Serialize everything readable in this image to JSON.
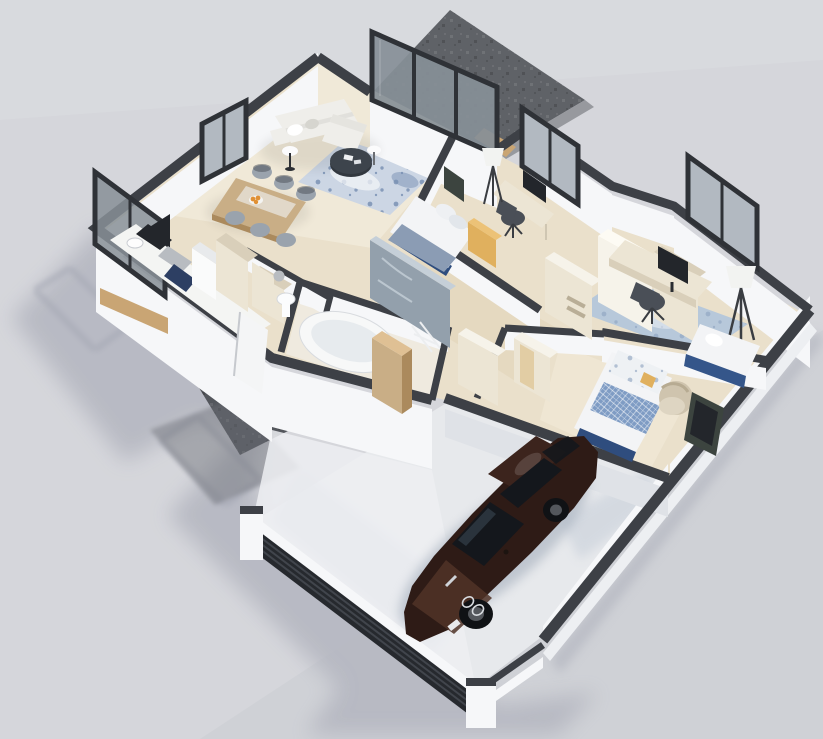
{
  "scene": {
    "title": "Isometric 3D floor plan render of a single-storey house with attached garage and parked sedan",
    "style": "photorealistic architectural visualization on plain light-gray backdrop, soft shadow cast to lower left",
    "rooms": [
      {
        "name": "terrace",
        "features": [
          "dark-stone-deck",
          "sliding-glass-door-wall"
        ]
      },
      {
        "name": "living-room",
        "features": [
          "white-l-shaped-sofa",
          "throw-pillows",
          "round-dark-coffee-table",
          "two-white-side-tables",
          "blue-speckled-rug",
          "wall-window"
        ]
      },
      {
        "name": "dining-area",
        "features": [
          "wood-dining-table",
          "six-gray-chairs",
          "orange-fruit-bowl"
        ]
      },
      {
        "name": "kitchen",
        "features": [
          "white-counter",
          "dark-cooktop",
          "steel-oven",
          "navy-cabinet-front",
          "white-fridge",
          "tall-cream-units",
          "glass-balustrade-window",
          "wood-planter-trim",
          "wall-art-panel"
        ]
      },
      {
        "name": "entry",
        "features": [
          "white-front-door-ajar",
          "dark-stone-walkway"
        ]
      },
      {
        "name": "wc",
        "features": [
          "pedestal-sink",
          "cream-shelf"
        ]
      },
      {
        "name": "bathroom",
        "features": [
          "oval-bathtub",
          "marble-shower-wall",
          "wood-cabinet",
          "towel-ladder"
        ]
      },
      {
        "name": "bedroom-1",
        "features": [
          "double-bed-gray-blue-blanket",
          "navy-bed-base",
          "yellow-wardrobe-panel",
          "desk-with-monitor",
          "office-chair",
          "tripod-floor-lamp",
          "wall-tv",
          "window"
        ]
      },
      {
        "name": "hallway",
        "features": [
          "cream-wardrobe-boxes",
          "white-storage-panels"
        ]
      },
      {
        "name": "home-office",
        "features": [
          "desk-with-monitor",
          "office-chair",
          "blue-rug",
          "tripod-floor-lamp",
          "window",
          "navy-daybed"
        ]
      },
      {
        "name": "bedroom-2",
        "features": [
          "double-bed-blue-diamond-blanket",
          "white-pillow-headboard",
          "navy-footboard",
          "beige-armchair",
          "dark-tv-panel",
          "cream-wardrobe"
        ]
      },
      {
        "name": "garage",
        "features": [
          "dark-brown-sedan",
          "slatted-dark-garage-door-wall",
          "white-corner-posts",
          "shadowed-concrete-floor"
        ]
      }
    ],
    "vehicle": {
      "type": "sedan",
      "color_name": "dark-brown",
      "orientation": "nose-toward-lower-left",
      "location": "garage"
    }
  },
  "colors": {
    "bg": "#d5d6db",
    "bg_vign": "#c6c8cf",
    "shadow": "#b4b6c0",
    "shadow_deep": "#a9acb8",
    "walkway": "#53565c",
    "walkway_light": "#6d7077",
    "terrace": "#5f6267",
    "terrace_edge": "#97999e",
    "wood_trim": "#c9a574",
    "wall_top": "#3d4046",
    "wall_face": "#f6f7f9",
    "wall_shade": "#dfe2e7",
    "plinth": "#edeff2",
    "floor_main": "#eae0cb",
    "floor_light": "#f1ead9",
    "floor_warm": "#e0d2b6",
    "floor_bath": "#efeadf",
    "floor_garage": "#e7e9ec",
    "garage_shade": "#b9c3d0",
    "glass_dark": "#878f97",
    "glass_light": "#b2b9c1",
    "frame_dark": "#2f3237",
    "rug_living": "#ccd6e4",
    "rug_office": "#b7c8da",
    "rug_speckle": "#768eb1",
    "rug_white": "#f2f4f7",
    "sofa": "#efeeea",
    "sofa_shade": "#d6d5cf",
    "table_wood": "#c9ae86",
    "wood_dark": "#ab8a5d",
    "chair_gray": "#9aa3ad",
    "chair_dark": "#4a4f57",
    "cream": "#ece5d4",
    "cream_side": "#d9cfba",
    "white_box": "#f6f3ea",
    "navy": "#2f4d7e",
    "bed_sheet": "#f3f4f6",
    "blanket_gray": "#8b9cb4",
    "blanket_blue": "#7f9cc4",
    "yellow": "#e0b05e",
    "tub_white": "#f7f8f8",
    "tub_inner": "#e7ebee",
    "marble": "#93a0ac",
    "marble_light": "#c5cfd8",
    "steel": "#b8bcc1",
    "dark_panel": "#23262b",
    "tv_panel": "#3c443f",
    "lamp": "#f2f3f1",
    "lamp_leg": "#3a3d42",
    "armchair": "#cfc4ae",
    "armchair_light": "#ded5c2",
    "daybed_navy": "#35568a",
    "car_body": "#2e1b16",
    "car_body_light": "#503227",
    "car_roof": "#3c241d",
    "car_glass": "#14171c",
    "car_glass_light": "#3d4a58",
    "wheel": "#101215",
    "wheel_rim": "#54575c",
    "grille": "#d8dbdf",
    "slat": "#26292e",
    "slat_line": "#41454c",
    "orange": "#e09034",
    "door_white": "#f4f5f6",
    "sink_white": "#fbfcfd"
  }
}
